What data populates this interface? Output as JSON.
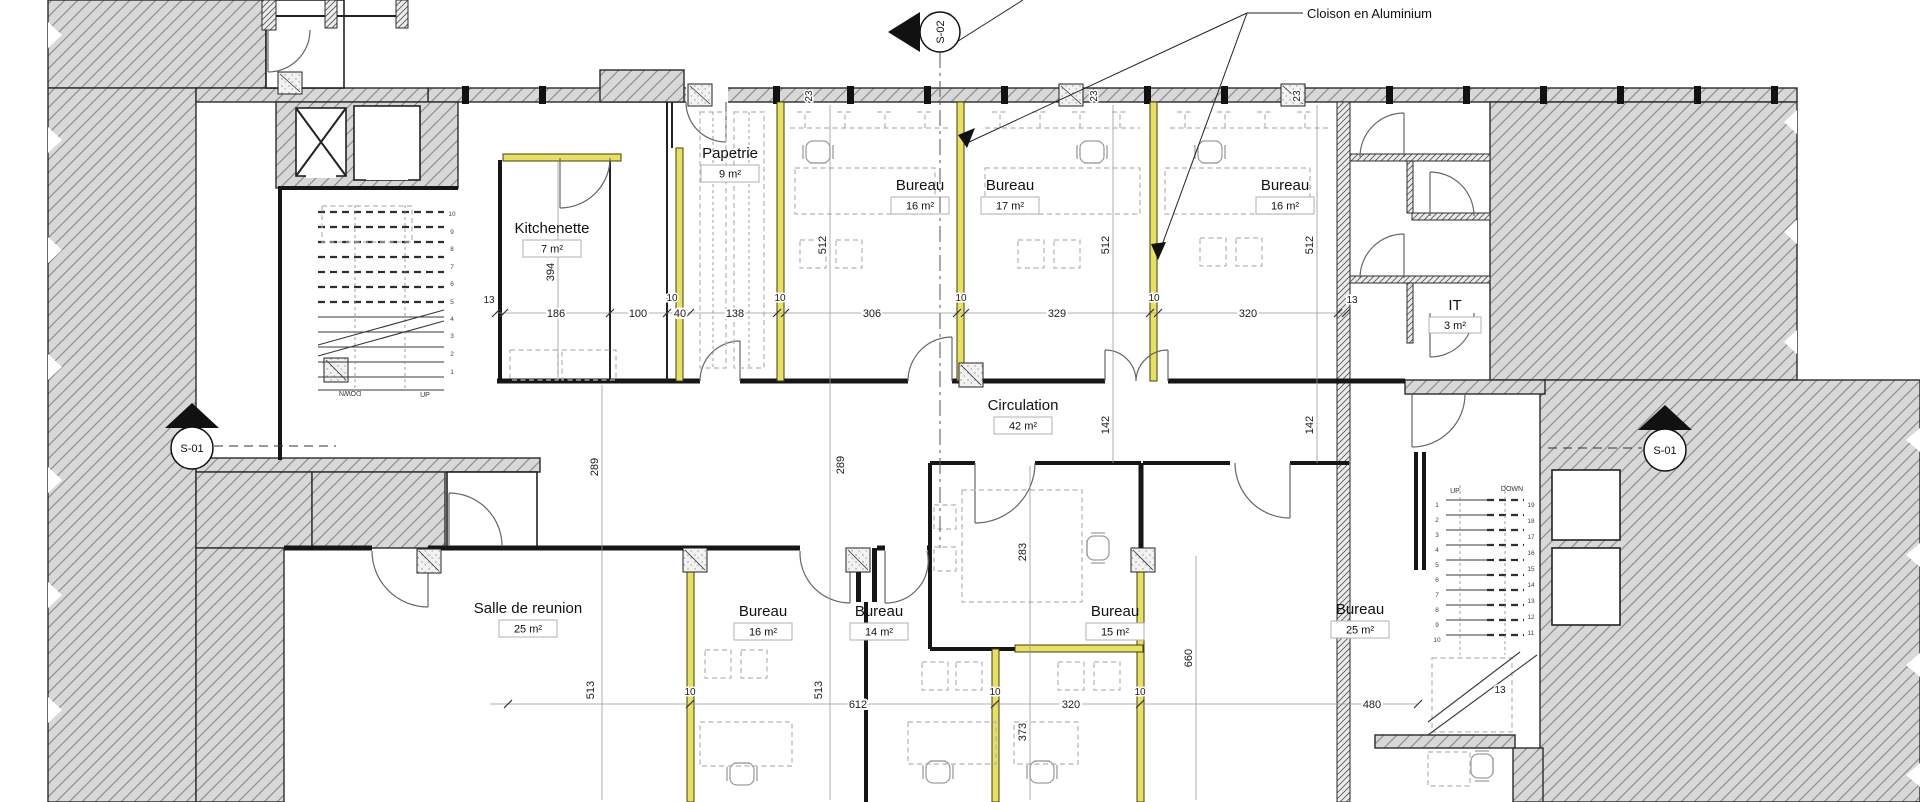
{
  "annotation": {
    "label": "Cloison en Aluminium"
  },
  "markers": {
    "s02": "S-02",
    "s01_left": "S-01",
    "s01_right": "S-01"
  },
  "rooms": [
    {
      "id": "kitchenette",
      "label": "Kitchenette",
      "area": "7 m²"
    },
    {
      "id": "papetrie",
      "label": "Papetrie",
      "area": "9 m²"
    },
    {
      "id": "bureau-top-1",
      "label": "Bureau",
      "area": "16 m²"
    },
    {
      "id": "bureau-top-2",
      "label": "Bureau",
      "area": "17 m²"
    },
    {
      "id": "bureau-top-3",
      "label": "Bureau",
      "area": "16 m²"
    },
    {
      "id": "it-room",
      "label": "IT",
      "area": "3 m²"
    },
    {
      "id": "circulation",
      "label": "Circulation",
      "area": "42 m²"
    },
    {
      "id": "salle-de-reunion",
      "label": "Salle de reunion",
      "area": "25 m²"
    },
    {
      "id": "bureau-bottom-1",
      "label": "Bureau",
      "area": "16 m²"
    },
    {
      "id": "bureau-bottom-2",
      "label": "Bureau",
      "area": "14 m²"
    },
    {
      "id": "bureau-bottom-3",
      "label": "Bureau",
      "area": "15 m²"
    },
    {
      "id": "bureau-bottom-4",
      "label": "Bureau",
      "area": "25 m²"
    }
  ],
  "dimensions": {
    "top_chain": {
      "wall_left": "13",
      "d186": "186",
      "d100": "100",
      "d40": "40",
      "d138": "138",
      "d306": "306",
      "d329": "329",
      "d320": "320",
      "wall_right": "13"
    },
    "bottom_chain": {
      "d612": "612",
      "d320": "320",
      "d480": "480"
    },
    "partition_thickness": "10",
    "wall_opening": "23",
    "stair_wall": "13",
    "v394": "394",
    "v512": "512",
    "v289": "289",
    "v142": "142",
    "v283": "283",
    "v373": "373",
    "v513": "513",
    "v660": "660"
  },
  "stairs": {
    "left": {
      "up": "UP",
      "down": "DOWN",
      "numbers": [
        "10",
        "9",
        "8",
        "7",
        "6",
        "5",
        "4",
        "3",
        "2",
        "1"
      ]
    },
    "right": {
      "up": "UP",
      "down": "DOWN",
      "numbers_right": [
        "19",
        "18",
        "17",
        "16",
        "15",
        "14",
        "13",
        "12",
        "11"
      ],
      "numbers_left": [
        "1",
        "2",
        "3",
        "4",
        "5",
        "6",
        "7",
        "8",
        "9",
        "10"
      ]
    }
  },
  "colors": {
    "partition": "#e9e15e",
    "wall_hatch": "#d8d8d8"
  }
}
